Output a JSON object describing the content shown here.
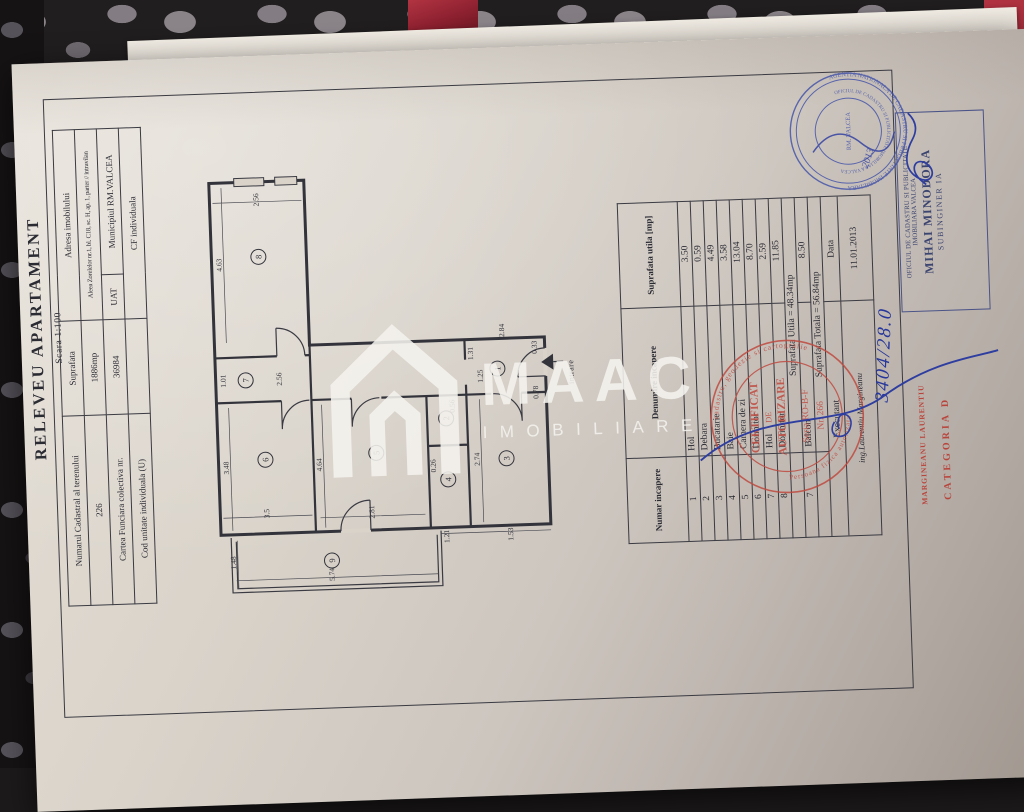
{
  "document": {
    "title": "RELEVEU APARTAMENT",
    "scale": "Scara 1:100"
  },
  "property_table": {
    "rows": [
      [
        {
          "t": "Numarul Cadastral al terenului"
        },
        {
          "t": "Suprafata"
        },
        {
          "t": "Adresa imobilului",
          "cs": 2
        }
      ],
      [
        {
          "t": "226"
        },
        {
          "t": "1886mp"
        },
        {
          "t": "Aleea Zorelelor nr.1, bl. C18, sc. H, ap. 1, parter  // intravilan",
          "cs": 2,
          "sm": 1
        }
      ],
      [
        {
          "t": "Cartea Funciara colectiva nr."
        },
        {
          "t": "36984"
        },
        {
          "t": "UAT"
        },
        {
          "t": "Municipiul RM.VALCEA"
        }
      ],
      [
        {
          "t": "Cod unitate individuala (U)"
        },
        {
          "t": ""
        },
        {
          "t": "CF individuala",
          "cs": 2
        }
      ]
    ]
  },
  "rooms_table": {
    "headers": [
      "Numar incapere",
      "Denumire incapere",
      "Suprafata utila [mp]"
    ],
    "rows": [
      [
        "1",
        "Hol",
        "3.50"
      ],
      [
        "2",
        "Debara",
        "0.59"
      ],
      [
        "3",
        "Bucatarie",
        "4.49"
      ],
      [
        "4",
        "Baie",
        "3.58"
      ],
      [
        "5",
        "Camera de zi",
        "13.04"
      ],
      [
        "6",
        "Dormitor",
        "8.70"
      ],
      [
        "7",
        "Hol",
        "2.59"
      ],
      [
        "8",
        "Dormitor",
        "11.85"
      ]
    ],
    "useful_area": "Suprafata Utila = 48.34mp",
    "balcony_row": [
      "7",
      "Balcon",
      "8.50"
    ],
    "total_area": "Suprafata Totala = 56.84mp",
    "executant_label": "Executant",
    "executant_name": "ing.Laurentiu Margineanu",
    "date_label": "Data",
    "date_value": "11.01.2013"
  },
  "plan": {
    "entrance_label": "intrare",
    "rooms": [
      {
        "n": "8",
        "x": 77,
        "y": 105
      },
      {
        "n": "7",
        "x": 60,
        "y": 228
      },
      {
        "n": "6",
        "x": 77,
        "y": 308
      },
      {
        "n": "9",
        "x": 140,
        "y": 411
      },
      {
        "n": "5",
        "x": 188,
        "y": 305
      },
      {
        "n": "1",
        "x": 312,
        "y": 225
      },
      {
        "n": "2",
        "x": 259,
        "y": 273
      },
      {
        "n": "4",
        "x": 259,
        "y": 334
      },
      {
        "n": "3",
        "x": 318,
        "y": 315
      }
    ],
    "dims": [
      {
        "v": "2.56",
        "x": 79,
        "y": 48
      },
      {
        "v": "4.63",
        "x": 40,
        "y": 112
      },
      {
        "v": "1.01",
        "x": 40,
        "y": 228
      },
      {
        "v": "2.56",
        "x": 96,
        "y": 228
      },
      {
        "v": "3.48",
        "x": 40,
        "y": 315
      },
      {
        "v": "3.5",
        "x": 79,
        "y": 362
      },
      {
        "v": "4.64",
        "x": 133,
        "y": 315
      },
      {
        "v": "2.81",
        "x": 184,
        "y": 364
      },
      {
        "v": "1.48",
        "x": 44,
        "y": 410
      },
      {
        "v": "5.74",
        "x": 142,
        "y": 425
      },
      {
        "v": "2.74",
        "x": 291,
        "y": 315
      },
      {
        "v": "1.53",
        "x": 322,
        "y": 391
      },
      {
        "v": "1.21",
        "x": 258,
        "y": 391
      },
      {
        "v": "2.84",
        "x": 320,
        "y": 187
      },
      {
        "v": "1.31",
        "x": 288,
        "y": 209
      },
      {
        "v": "1.25",
        "x": 297,
        "y": 232
      },
      {
        "v": "0.33",
        "x": 352,
        "y": 205
      },
      {
        "v": "0.78",
        "x": 352,
        "y": 250
      },
      {
        "v": "0.56",
        "x": 268,
        "y": 261
      },
      {
        "v": "0.26",
        "x": 247,
        "y": 320
      }
    ]
  },
  "stamps": {
    "rect": {
      "lines": [
        "OFICIUL DE CADASTRU SI PUBLICITATE",
        "IMOBILIARA VALCEA",
        "MIHAI MINODORA",
        "SUBINGINER IA"
      ]
    },
    "blue_round": {
      "outer": "AGENTIA NATIONALA DE CADASTRU SI PUBLICITATE IMOBILIARA",
      "inner": "OFICIUL DE CADASTRU SI PUBLICITATE IMOBILIARA VALCEA",
      "center": "RM. VALCEA",
      "handwritten": "2013"
    },
    "red_round": {
      "ring_top": "cadastru, geodezie si cartografie",
      "ring_bottom": "Persoana fizica autorizata",
      "center": [
        "CERTIFICAT",
        "DE",
        "AUTORIZARE",
        "Seria RO-B-F",
        "Nr. 266"
      ],
      "name": "MARGINEANU LAURENTIU",
      "category": "CATEGORIA D"
    },
    "handwritten_number": "3404/28.0"
  },
  "watermark": {
    "brand": "MAAC",
    "sub": "IMOBILIARE"
  }
}
